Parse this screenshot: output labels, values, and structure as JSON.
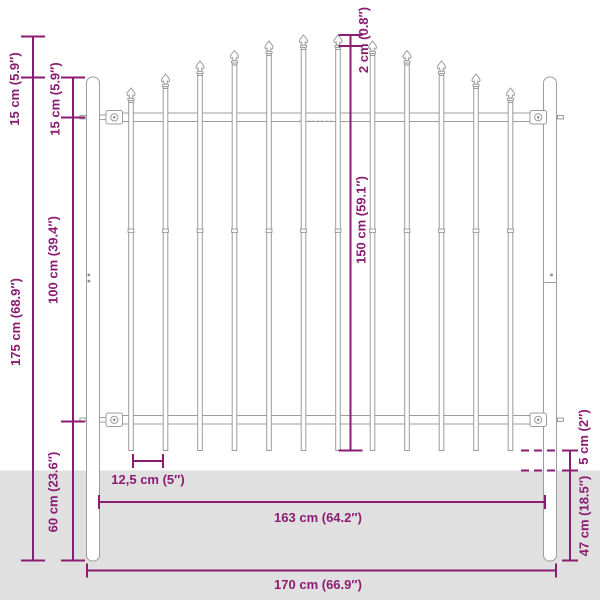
{
  "diagram": {
    "type": "product-dimension-diagram",
    "subject": "steel fence panel with spear top and two posts",
    "colors": {
      "dimension": "#8b1c72",
      "ground": "#e0e0e0",
      "outline": "#9c9c9c",
      "background": "#ffffff"
    },
    "labels": {
      "arch_rise": "15 cm (5.9″)",
      "post_top_to_rail": "15 cm (5.9″)",
      "rail_to_rail": "100 cm (39.4″)",
      "post_height": "175 cm (68.9″)",
      "rail_to_post_bottom": "60 cm (23.6″)",
      "bar_spacing": "12,5 cm (5″)",
      "bar_step": "2 cm (0.8″)",
      "bar_length": "150 cm (59.1″)",
      "inner_width": "163 cm (64.2″)",
      "total_width": "170 cm (66.9″)",
      "ground_clearance": "5 cm (2″)",
      "post_underground": "47 cm (18.5″)"
    },
    "measurements": [
      {
        "id": "arch_rise",
        "value_cm": 15,
        "value_in": 5.9,
        "text": "15 cm (5.9″)"
      },
      {
        "id": "post_top_to_rail",
        "value_cm": 15,
        "value_in": 5.9,
        "text": "15 cm (5.9″)"
      },
      {
        "id": "rail_to_rail",
        "value_cm": 100,
        "value_in": 39.4,
        "text": "100 cm (39.4″)"
      },
      {
        "id": "post_height",
        "value_cm": 175,
        "value_in": 68.9,
        "text": "175 cm (68.9″)"
      },
      {
        "id": "rail_to_post_bottom",
        "value_cm": 60,
        "value_in": 23.6,
        "text": "60 cm (23.6″)"
      },
      {
        "id": "bar_spacing",
        "value_cm": 12.5,
        "value_in": 5,
        "text": "12,5 cm (5″)"
      },
      {
        "id": "bar_step",
        "value_cm": 2,
        "value_in": 0.8,
        "text": "2 cm (0.8″)"
      },
      {
        "id": "bar_length",
        "value_cm": 150,
        "value_in": 59.1,
        "text": "150 cm (59.1″)"
      },
      {
        "id": "inner_width",
        "value_cm": 163,
        "value_in": 64.2,
        "text": "163 cm (64.2″)"
      },
      {
        "id": "total_width",
        "value_cm": 170,
        "value_in": 66.9,
        "text": "170 cm (66.9″)"
      },
      {
        "id": "ground_clearance",
        "value_cm": 5,
        "value_in": 2,
        "text": "5 cm (2″)"
      },
      {
        "id": "post_underground",
        "value_cm": 47,
        "value_in": 18.5,
        "text": "47 cm (18.5″)"
      }
    ]
  }
}
